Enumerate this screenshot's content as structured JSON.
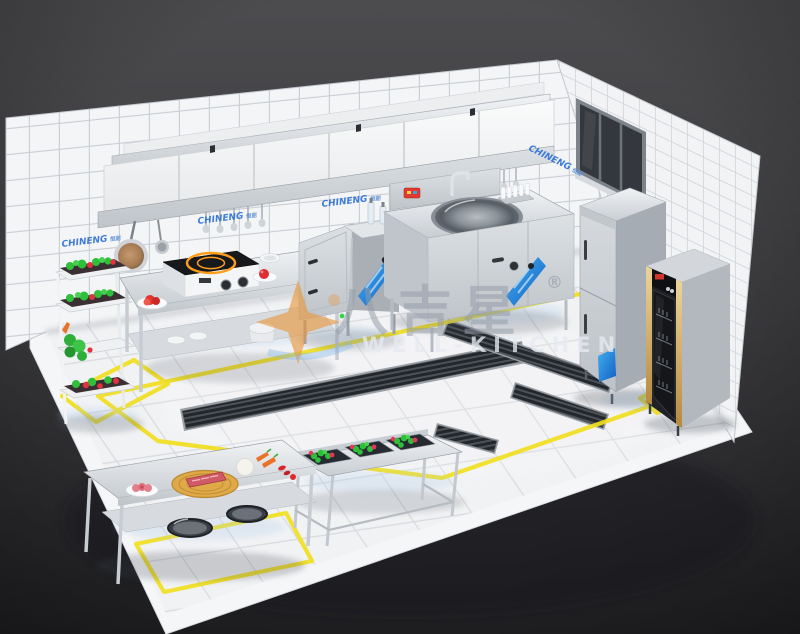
{
  "brand": {
    "label": "CHINENG",
    "suffix": "恒能",
    "color": "#2b6fd4"
  },
  "watermark": {
    "zh": "八吉星",
    "registered": "®",
    "en": "WELL-KITCHEN"
  },
  "palette": {
    "background_top": "#4c4c4f",
    "background_bottom": "#232326",
    "wall_tile": "#f4f5f7",
    "grout": "#c9ced4",
    "floor_tile": "#eff1f3",
    "safety_yellow": "#f1df1f",
    "stainless": "#cdd2d7",
    "banner_blue": "#2b8fe0",
    "drain_dark": "#23262a",
    "veg_green": "#2fbf3a",
    "food_red": "#e03240",
    "wood_board": "#dfa948",
    "induction_orange": "#ff9e1b",
    "cabinet_black": "#1f2126",
    "cabinet_gold": "#d7b26a"
  },
  "objects": [
    "tiled-back-wall",
    "tiled-right-wall",
    "window",
    "range-hood-with-shelf",
    "hanging-frying-pan",
    "hanging-ladles",
    "vegetable-tier-rack",
    "stainless-work-table",
    "induction-cooker",
    "steamer-cabinet",
    "large-wok-station",
    "sink-faucet",
    "seasoning-bottles",
    "upright-refrigerator",
    "disinfection-cabinet",
    "three-compartment-veg-sink",
    "prep-table-with-cutting-board",
    "floor-drain-channels",
    "yellow-safety-floor-lines",
    "marble-tile-floor"
  ]
}
